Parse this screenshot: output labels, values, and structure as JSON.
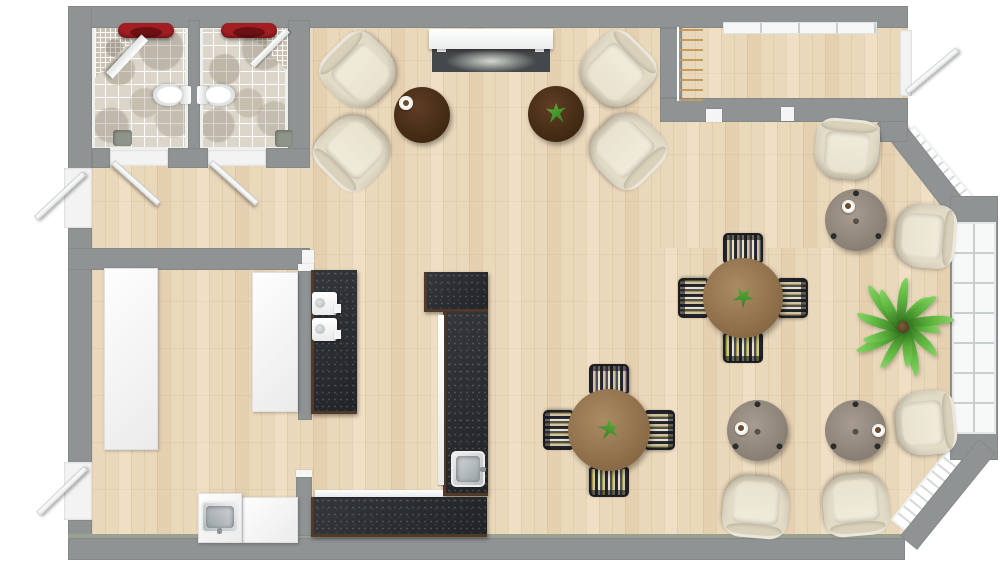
{
  "meta": {
    "title": "cafe-floor-plan",
    "canvas": {
      "w": 1000,
      "h": 569
    }
  },
  "palette": {
    "wall": "#8f9394",
    "wood_floor": "#ead8bb",
    "tile_floor": "#dcd6ca",
    "counter_dark": "#2c2f32",
    "counter_wood_edge": "#53392a",
    "dining_wood": "#8a6a46",
    "coffee_table_wood": "#402812",
    "side_table_taupe": "#8b8075",
    "armchair_cream": "#e2dbc6",
    "accent_red": "#a21e23",
    "plant_green": "#5cb33c"
  },
  "rooms": [
    {
      "name": "bathroom-left",
      "floor": "tile"
    },
    {
      "name": "bathroom-right",
      "floor": "tile"
    },
    {
      "name": "vestibule",
      "floor": "wood"
    },
    {
      "name": "lounge",
      "floor": "wood"
    },
    {
      "name": "entry-corridor",
      "floor": "wood"
    },
    {
      "name": "kitchen",
      "floor": "wood"
    },
    {
      "name": "cafe-seating-area",
      "floor": "wood"
    },
    {
      "name": "bay-window-lounge",
      "floor": "wood"
    }
  ],
  "furniture": [
    {
      "type": "counter-white",
      "name": "kitchen-wall-cabinets",
      "cx": 131,
      "cy": 359,
      "w": 54,
      "h": 182,
      "rot": 0
    },
    {
      "type": "counter-white",
      "name": "kitchen-side-counter",
      "cx": 275,
      "cy": 342,
      "w": 46,
      "h": 140,
      "rot": 0
    },
    {
      "type": "counter-white",
      "name": "kitchen-bottom-counter",
      "cx": 270,
      "cy": 520,
      "w": 56,
      "h": 46,
      "rot": 0
    },
    {
      "type": "counter-white",
      "name": "kitchen-sink-cabinet",
      "cx": 220,
      "cy": 518,
      "w": 44,
      "h": 50,
      "rot": 0
    },
    {
      "type": "steel-sink",
      "name": "kitchen-sink",
      "cx": 220,
      "cy": 517,
      "w": 32,
      "h": 38,
      "rot": 90
    },
    {
      "type": "counter-black",
      "name": "espresso-counter",
      "cx": 334,
      "cy": 342,
      "w": 46,
      "h": 144,
      "rot": 0
    },
    {
      "type": "espresso-machine",
      "name": "espresso-machine",
      "cx": 324,
      "cy": 303,
      "w": 25,
      "h": 23,
      "rot": 0
    },
    {
      "type": "espresso-machine",
      "name": "espresso-machine",
      "cx": 324,
      "cy": 329,
      "w": 25,
      "h": 23,
      "rot": 0
    },
    {
      "type": "counter-black",
      "name": "bar-counter-top-block",
      "cx": 456,
      "cy": 292,
      "w": 64,
      "h": 40,
      "rot": 0
    },
    {
      "type": "counter-black",
      "name": "bar-counter-vertical",
      "cx": 465,
      "cy": 404,
      "w": 45,
      "h": 184,
      "rot": 0
    },
    {
      "type": "counter-black",
      "name": "bar-counter-bottom",
      "cx": 399,
      "cy": 517,
      "w": 176,
      "h": 40,
      "rot": 0
    },
    {
      "type": "shelf-strip",
      "name": "bar-shelf-edge",
      "cx": 379,
      "cy": 493,
      "w": 128,
      "h": 7,
      "rot": 0
    },
    {
      "type": "shelf-strip",
      "name": "bar-shelf-edge",
      "cx": 441,
      "cy": 400,
      "w": 6,
      "h": 170,
      "rot": 0
    },
    {
      "type": "steel-sink",
      "name": "bar-sink",
      "cx": 468,
      "cy": 469,
      "w": 34,
      "h": 36,
      "rot": 0
    },
    {
      "type": "console",
      "name": "media-console",
      "cx": 491,
      "cy": 39,
      "w": 124,
      "h": 20,
      "rot": 0
    },
    {
      "type": "tv-panel",
      "name": "tv-screen",
      "cx": 491,
      "cy": 60,
      "w": 118,
      "h": 24,
      "rot": 0
    },
    {
      "type": "coat-rack",
      "name": "coat-rack",
      "cx": 690,
      "cy": 64,
      "w": 26,
      "h": 74,
      "rot": 0
    },
    {
      "type": "armchair",
      "name": "lounge-armchair",
      "cx": 359,
      "cy": 71,
      "w": 68,
      "h": 68,
      "rot": -45
    },
    {
      "type": "armchair",
      "name": "lounge-armchair",
      "cx": 353,
      "cy": 152,
      "w": 68,
      "h": 68,
      "rot": -135
    },
    {
      "type": "armchair",
      "name": "lounge-armchair",
      "cx": 617,
      "cy": 70,
      "w": 68,
      "h": 68,
      "rot": 45
    },
    {
      "type": "armchair",
      "name": "lounge-armchair",
      "cx": 627,
      "cy": 150,
      "w": 68,
      "h": 68,
      "rot": 135
    },
    {
      "type": "armchair",
      "name": "bay-armchair",
      "cx": 847,
      "cy": 149,
      "w": 64,
      "h": 60,
      "rot": 5
    },
    {
      "type": "armchair",
      "name": "bay-armchair",
      "cx": 926,
      "cy": 236,
      "w": 64,
      "h": 60,
      "rot": 95
    },
    {
      "type": "armchair",
      "name": "bay-armchair",
      "cx": 926,
      "cy": 423,
      "w": 64,
      "h": 60,
      "rot": 85
    },
    {
      "type": "armchair",
      "name": "bay-armchair",
      "cx": 756,
      "cy": 507,
      "w": 66,
      "h": 62,
      "rot": 185
    },
    {
      "type": "armchair",
      "name": "bay-armchair",
      "cx": 856,
      "cy": 505,
      "w": 66,
      "h": 62,
      "rot": 175
    },
    {
      "type": "coffee-table",
      "name": "coffee-table",
      "cx": 422,
      "cy": 115,
      "w": 56,
      "h": 56,
      "rot": 0
    },
    {
      "type": "coffee-table",
      "name": "coffee-table",
      "cx": 556,
      "cy": 114,
      "w": 56,
      "h": 56,
      "rot": 0
    },
    {
      "type": "side-table",
      "name": "round-side-table",
      "cx": 856,
      "cy": 220,
      "w": 62,
      "h": 62,
      "rot": 0
    },
    {
      "type": "side-table",
      "name": "round-side-table",
      "cx": 757,
      "cy": 430,
      "w": 61,
      "h": 61,
      "rot": 0
    },
    {
      "type": "side-table",
      "name": "round-side-table",
      "cx": 855,
      "cy": 430,
      "w": 61,
      "h": 61,
      "rot": 0
    },
    {
      "type": "dining-chair",
      "name": "dining-chair",
      "cx": 743,
      "cy": 248,
      "w": 40,
      "h": 30,
      "rot": 0
    },
    {
      "type": "dining-chair",
      "name": "dining-chair",
      "cx": 793,
      "cy": 298,
      "w": 40,
      "h": 30,
      "rot": 90
    },
    {
      "type": "dining-chair",
      "name": "dining-chair",
      "cx": 743,
      "cy": 348,
      "w": 40,
      "h": 30,
      "rot": 180
    },
    {
      "type": "dining-chair",
      "name": "dining-chair",
      "cx": 693,
      "cy": 298,
      "w": 40,
      "h": 30,
      "rot": 270
    },
    {
      "type": "dining-table",
      "name": "round-dining-table",
      "cx": 743,
      "cy": 298,
      "w": 80,
      "h": 80,
      "rot": 0
    },
    {
      "type": "dining-chair",
      "name": "dining-chair",
      "cx": 609,
      "cy": 379,
      "w": 40,
      "h": 30,
      "rot": 0
    },
    {
      "type": "dining-chair",
      "name": "dining-chair",
      "cx": 660,
      "cy": 430,
      "w": 40,
      "h": 30,
      "rot": 90
    },
    {
      "type": "dining-chair",
      "name": "dining-chair",
      "cx": 609,
      "cy": 482,
      "w": 40,
      "h": 30,
      "rot": 180
    },
    {
      "type": "dining-chair",
      "name": "dining-chair",
      "cx": 558,
      "cy": 430,
      "w": 40,
      "h": 30,
      "rot": 270
    },
    {
      "type": "dining-table",
      "name": "round-dining-table",
      "cx": 609,
      "cy": 430,
      "w": 82,
      "h": 82,
      "rot": 0
    },
    {
      "type": "plant-sprig",
      "name": "table-plant",
      "cx": 556,
      "cy": 113,
      "w": 20,
      "h": 20,
      "rot": 0
    },
    {
      "type": "plant-sprig",
      "name": "table-plant",
      "cx": 743,
      "cy": 297,
      "w": 20,
      "h": 20,
      "rot": 40
    },
    {
      "type": "plant-sprig",
      "name": "table-plant",
      "cx": 609,
      "cy": 429,
      "w": 20,
      "h": 20,
      "rot": 70
    },
    {
      "type": "cup",
      "name": "coffee-cup",
      "cx": 406,
      "cy": 103,
      "w": 14,
      "h": 14,
      "rot": 0
    },
    {
      "type": "cup",
      "name": "coffee-cup",
      "cx": 848,
      "cy": 206,
      "w": 13,
      "h": 13,
      "rot": 0
    },
    {
      "type": "cup",
      "name": "coffee-cup",
      "cx": 741,
      "cy": 428,
      "w": 13,
      "h": 13,
      "rot": 0
    },
    {
      "type": "cup",
      "name": "coffee-cup",
      "cx": 878,
      "cy": 430,
      "w": 13,
      "h": 13,
      "rot": 0
    },
    {
      "type": "palm",
      "name": "potted-palm-plant",
      "cx": 903,
      "cy": 327,
      "w": 104,
      "h": 104,
      "rot": 0
    },
    {
      "type": "toilet",
      "name": "toilet",
      "cx": 172,
      "cy": 95,
      "w": 24,
      "h": 38,
      "rot": 90
    },
    {
      "type": "toilet",
      "name": "toilet",
      "cx": 216,
      "cy": 95,
      "w": 24,
      "h": 38,
      "rot": -90
    },
    {
      "type": "red-sink",
      "name": "red-basin",
      "cx": 146,
      "cy": 30,
      "w": 56,
      "h": 15,
      "rot": 0
    },
    {
      "type": "red-sink",
      "name": "red-basin",
      "cx": 249,
      "cy": 30,
      "w": 56,
      "h": 15,
      "rot": 0
    },
    {
      "type": "mat",
      "name": "floor-drain",
      "cx": 122,
      "cy": 138,
      "w": 19,
      "h": 16,
      "rot": 0
    },
    {
      "type": "mat",
      "name": "floor-drain",
      "cx": 284,
      "cy": 138,
      "w": 18,
      "h": 17,
      "rot": 0
    },
    {
      "type": "screen",
      "name": "shower-screen",
      "cx": 127,
      "cy": 56,
      "w": 52,
      "h": 9,
      "rot": 133
    },
    {
      "type": "screen",
      "name": "shower-screen",
      "cx": 270,
      "cy": 48,
      "w": 50,
      "h": 6,
      "rot": -45
    },
    {
      "type": "radiator",
      "name": "radiator",
      "cx": 937,
      "cy": 172,
      "w": 100,
      "h": 26,
      "rot": 50
    },
    {
      "type": "radiator",
      "name": "radiator",
      "cx": 930,
      "cy": 490,
      "w": 96,
      "h": 24,
      "rot": -51
    },
    {
      "type": "door-leaf",
      "name": "bathroom-door",
      "cx": 136,
      "cy": 183,
      "w": 62,
      "h": 6,
      "rot": 42
    },
    {
      "type": "door-leaf",
      "name": "bathroom-door",
      "cx": 234,
      "cy": 183,
      "w": 62,
      "h": 6,
      "rot": 42
    },
    {
      "type": "door-leaf",
      "name": "exterior-door",
      "cx": 60,
      "cy": 196,
      "w": 66,
      "h": 6,
      "rot": -43
    },
    {
      "type": "door-leaf",
      "name": "exterior-door",
      "cx": 62,
      "cy": 491,
      "w": 66,
      "h": 6,
      "rot": -44
    },
    {
      "type": "door-leaf",
      "name": "entry-door",
      "cx": 932,
      "cy": 71,
      "w": 66,
      "h": 6,
      "rot": -40
    }
  ]
}
